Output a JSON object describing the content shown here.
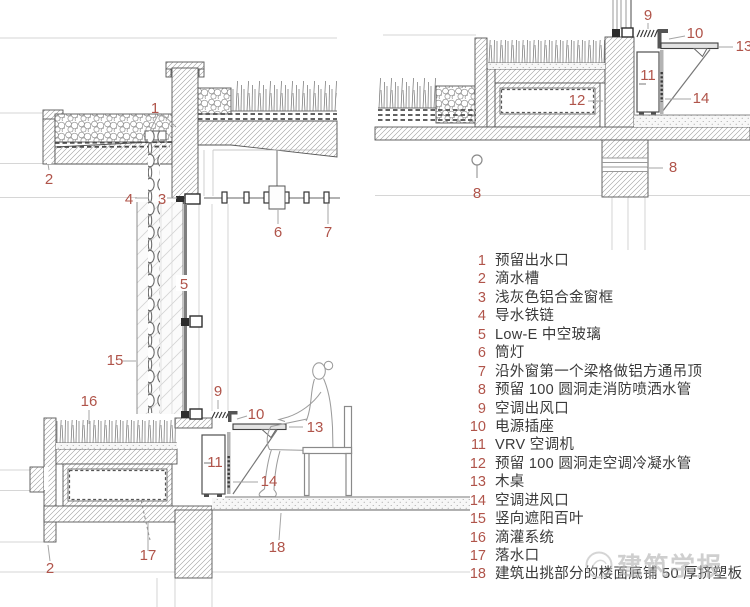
{
  "page": {
    "width": 750,
    "height": 607,
    "background": "#ffffff"
  },
  "colors": {
    "callout_accent": "#b0544a",
    "legend_text": "#3a3a3a",
    "line_dark": "#4a4a4a",
    "line_mid": "#8a8a8a",
    "hatch": "#9d9d9d",
    "reference_line": "#c9c9c9",
    "watermark": "#b3b3b3"
  },
  "legend": {
    "items": [
      {
        "num": "1",
        "label": "预留出水口"
      },
      {
        "num": "2",
        "label": "滴水槽"
      },
      {
        "num": "3",
        "label": "浅灰色铝合金窗框"
      },
      {
        "num": "4",
        "label": "导水铁链"
      },
      {
        "num": "5",
        "label": "Low-E 中空玻璃"
      },
      {
        "num": "6",
        "label": "筒灯"
      },
      {
        "num": "7",
        "label": "沿外窗第一个梁格做铝方通吊顶"
      },
      {
        "num": "8",
        "label": "预留 100 圆洞走消防喷洒水管"
      },
      {
        "num": "9",
        "label": "空调出风口"
      },
      {
        "num": "10",
        "label": "电源插座"
      },
      {
        "num": "11",
        "label": "VRV 空调机"
      },
      {
        "num": "12",
        "label": "预留 100 圆洞走空调冷凝水管"
      },
      {
        "num": "13",
        "label": "木桌"
      },
      {
        "num": "14",
        "label": "空调进风口"
      },
      {
        "num": "15",
        "label": "竖向遮阳百叶"
      },
      {
        "num": "16",
        "label": "滴灌系统"
      },
      {
        "num": "17",
        "label": "落水口"
      },
      {
        "num": "18",
        "label": "建筑出挑部分的楼面底铺 50 厚挤塑板"
      }
    ]
  },
  "callouts": {
    "tl": [
      "1",
      "2",
      "3",
      "4",
      "5",
      "6",
      "7"
    ],
    "tr": [
      "9",
      "10",
      "13",
      "11",
      "12",
      "14",
      "8",
      "8"
    ],
    "bl": [
      "15",
      "16",
      "9",
      "10",
      "13",
      "11",
      "14",
      "17",
      "2",
      "18"
    ]
  },
  "watermark": {
    "text": "建筑学报"
  }
}
